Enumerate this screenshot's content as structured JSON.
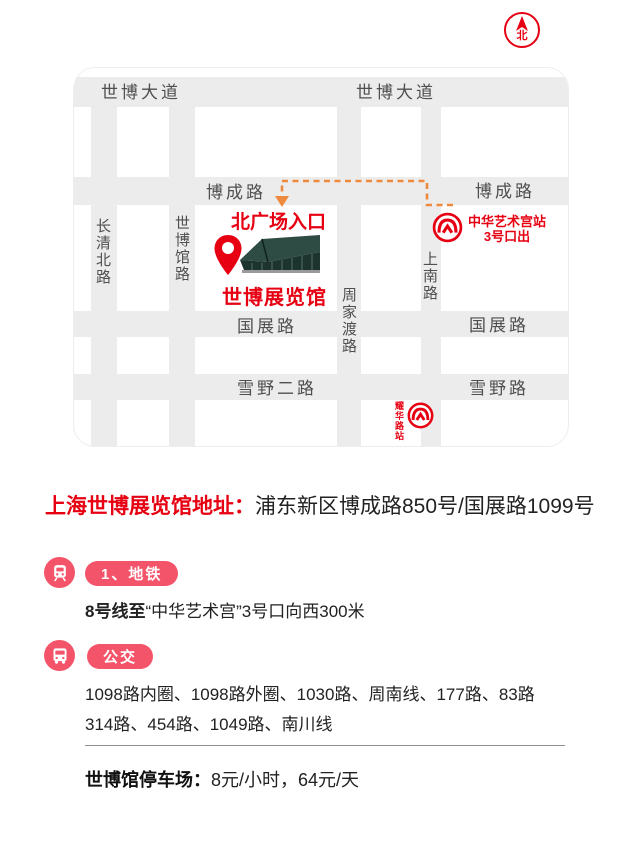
{
  "compass": {
    "north": "北"
  },
  "map": {
    "road_labels": {
      "shibo_avenue": "世博大道",
      "bocheng_road": "博成路",
      "changqing_north_road": "长清北路",
      "shibo_hall_road": "世博馆路",
      "zhoujiadu_road": "周家渡路",
      "shangnan_road": "上南路",
      "guozhan_road": "国展路",
      "xueye_2nd_road": "雪野二路",
      "xueye_road": "雪野路"
    },
    "markers": {
      "north_plaza_entrance": "北广场入口",
      "expo_exhibition_hall": "世博展览馆",
      "art_museum_station": "中华艺术宫站",
      "art_museum_exit": "3号口出",
      "yaohua_road_station": "耀华路站"
    }
  },
  "address": {
    "label": "上海世博展览馆地址：",
    "value": "浦东新区博成路850号/国展路1099号"
  },
  "metro": {
    "badge": "1、地铁",
    "route_prefix": "8号线至",
    "route_rest": "“中华艺术宫”3号口向西300米"
  },
  "bus": {
    "badge": "公交",
    "line1": "1098路内圈、1098路外圈、1030路、周南线、177路、83路",
    "line2": "314路、454路、1049路、南川线"
  },
  "parking": {
    "label": "世博馆停车场：",
    "value": "8元/小时，64元/天"
  },
  "colors": {
    "red": "#e60012",
    "pink": "#f4546a",
    "orange": "#ee8a3e",
    "road_gray": "#ececec"
  }
}
